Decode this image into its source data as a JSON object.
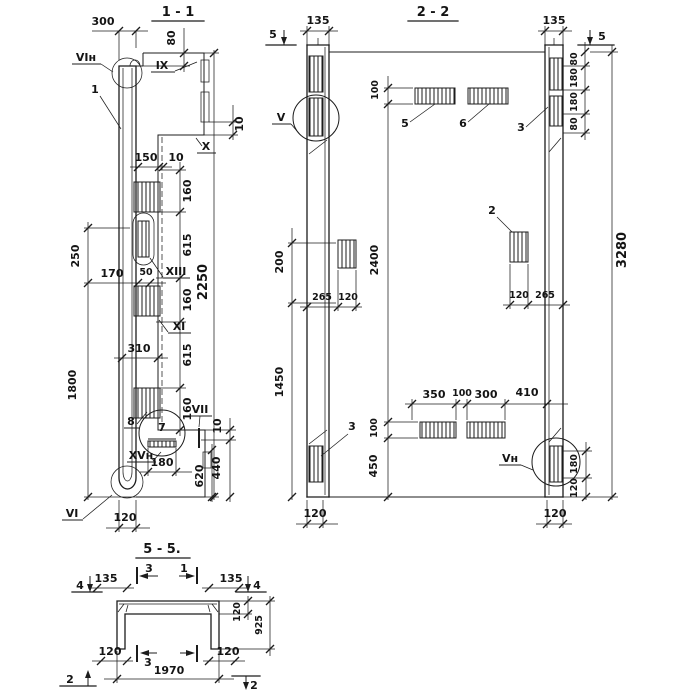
{
  "meta": {
    "background": "#ffffff",
    "ink": "#1c1c1c",
    "drawing_type": "reinforced concrete panel sections"
  },
  "s11": {
    "title": "1 - 1",
    "dims": {
      "top_300": "300",
      "top_80": "80",
      "right_10_top": "10",
      "step_150": "150",
      "step_10": "10",
      "ch_160_1": "160",
      "ch_615_1": "615",
      "ch_160_2": "160",
      "ch_615_2": "615",
      "ch_160_3": "160",
      "total_2250": "2250",
      "left_250": "250",
      "left_1800": "1800",
      "mid_170": "170",
      "mid_50": "50",
      "mid_310": "310",
      "bot_180": "180",
      "bot_620": "620",
      "bot_440": "440",
      "bot_10": "10",
      "bot_120": "120"
    },
    "refs": {
      "vi_n": "VIн",
      "ix": "IX",
      "x": "X",
      "xiii": "XIII",
      "xi": "XI",
      "vii": "VII",
      "xv_n": "XVн",
      "vi": "VI"
    },
    "parts": {
      "p1": "1",
      "p7": "7",
      "p8": "8"
    }
  },
  "s22": {
    "title": "2 - 2",
    "cuts": {
      "c5_left": "5",
      "c5_right": "5"
    },
    "dims": {
      "top_135_l": "135",
      "top_135_r": "135",
      "rt_80_1": "80",
      "rt_180_1": "180",
      "rt_180_2": "180",
      "rt_80_2": "80",
      "right_3280": "3280",
      "left_200": "200",
      "left_1450": "1450",
      "mid_2400": "2400",
      "top_100": "100",
      "ml_265": "265",
      "ml_120": "120",
      "mr_120": "120",
      "mr_265": "265",
      "b_350": "350",
      "b_100": "100",
      "b_300": "300",
      "b_410": "410",
      "bm_100": "100",
      "bm_450": "450",
      "rb_180": "180",
      "rb_120": "120",
      "bot_120_l": "120",
      "bot_120_r": "120"
    },
    "refs": {
      "v": "V",
      "v_n": "Vн"
    },
    "parts": {
      "p5": "5",
      "p6": "6",
      "p3_top": "3",
      "p2": "2",
      "p3_bot": "3"
    }
  },
  "s55": {
    "title": "5 - 5.",
    "cuts": {
      "c4_l": "4",
      "c4_r": "4",
      "c3_top": "3",
      "c1_top": "1",
      "c3_bot": "3",
      "c2_l": "2",
      "c2_r": "2"
    },
    "dims": {
      "t135_l": "135",
      "t135_r": "135",
      "r_120": "120",
      "r_925": "925",
      "b_120_l": "120",
      "b_120_r": "120",
      "w_1970": "1970"
    }
  }
}
